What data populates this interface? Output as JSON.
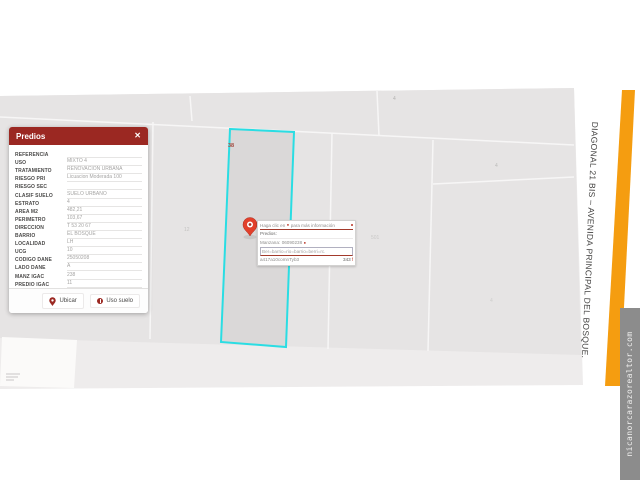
{
  "panel": {
    "title": "Predios",
    "fields": [
      {
        "label": "REFERENCIA",
        "value": ""
      },
      {
        "label": "USO",
        "value": "MIXTO 4"
      },
      {
        "label": "TRATAMIENTO",
        "value": "RENOVACION URBANA"
      },
      {
        "label": "RIESGO PRI",
        "value": "Licuacion Moderada 100"
      },
      {
        "label": "RIESGO SEC",
        "value": ""
      },
      {
        "label": "CLASIF SUELO",
        "value": "SUELO URBANO"
      },
      {
        "label": "ESTRATO",
        "value": "4"
      },
      {
        "label": "AREA M2",
        "value": "482,21"
      },
      {
        "label": "PERIMETRO",
        "value": "103,67"
      },
      {
        "label": "DIRECCION",
        "value": "T 53 20 67"
      },
      {
        "label": "BARRIO",
        "value": "EL BOSQUE"
      },
      {
        "label": "LOCALIDAD",
        "value": "LH"
      },
      {
        "label": "UCG",
        "value": "10"
      },
      {
        "label": "CODIGO DANE",
        "value": "25050208"
      },
      {
        "label": "LADO DANE",
        "value": "A"
      },
      {
        "label": "MANZ IGAC",
        "value": "238"
      },
      {
        "label": "PREDIO IGAC",
        "value": "11"
      }
    ],
    "buttons": {
      "ubicar": "Ubicar",
      "uso_suelo": "Uso suelo"
    }
  },
  "map": {
    "labels": [
      {
        "text": "38"
      },
      {
        "text": "12"
      },
      {
        "text": "501"
      },
      {
        "text": "4"
      },
      {
        "text": "4"
      },
      {
        "text": "4"
      }
    ],
    "tooltip": {
      "line1_prefix": "Haga clic en",
      "line1_suffix": "para más información",
      "line2": "Predios:",
      "line3_label": "Manzana:",
      "line3_value": "06090238",
      "line4": "Ber=barrio=rio=barrio=berri=rc.",
      "line5_left": "a417a10comnTyb3",
      "line5_right": "343",
      "line5_suffix": "f"
    },
    "street_label": "DIAGONAL 21 BIS – AVENIDA PRINCIPAL DEL BOSQUE."
  },
  "watermark": "nicanorcarazorealtor.com",
  "icons": {
    "close": "✕",
    "tooltip_pin": "●",
    "tooltip_marker": "●",
    "ubicar_icon": "map-pin",
    "uso_suelo_icon": "info-circle"
  },
  "colors": {
    "panel_header": "#9b2822",
    "selection_cyan": "#2adde3",
    "road_orange": "#f59d10",
    "pin_red": "#e2402b",
    "map_block_gray": "#e6e4e4"
  }
}
